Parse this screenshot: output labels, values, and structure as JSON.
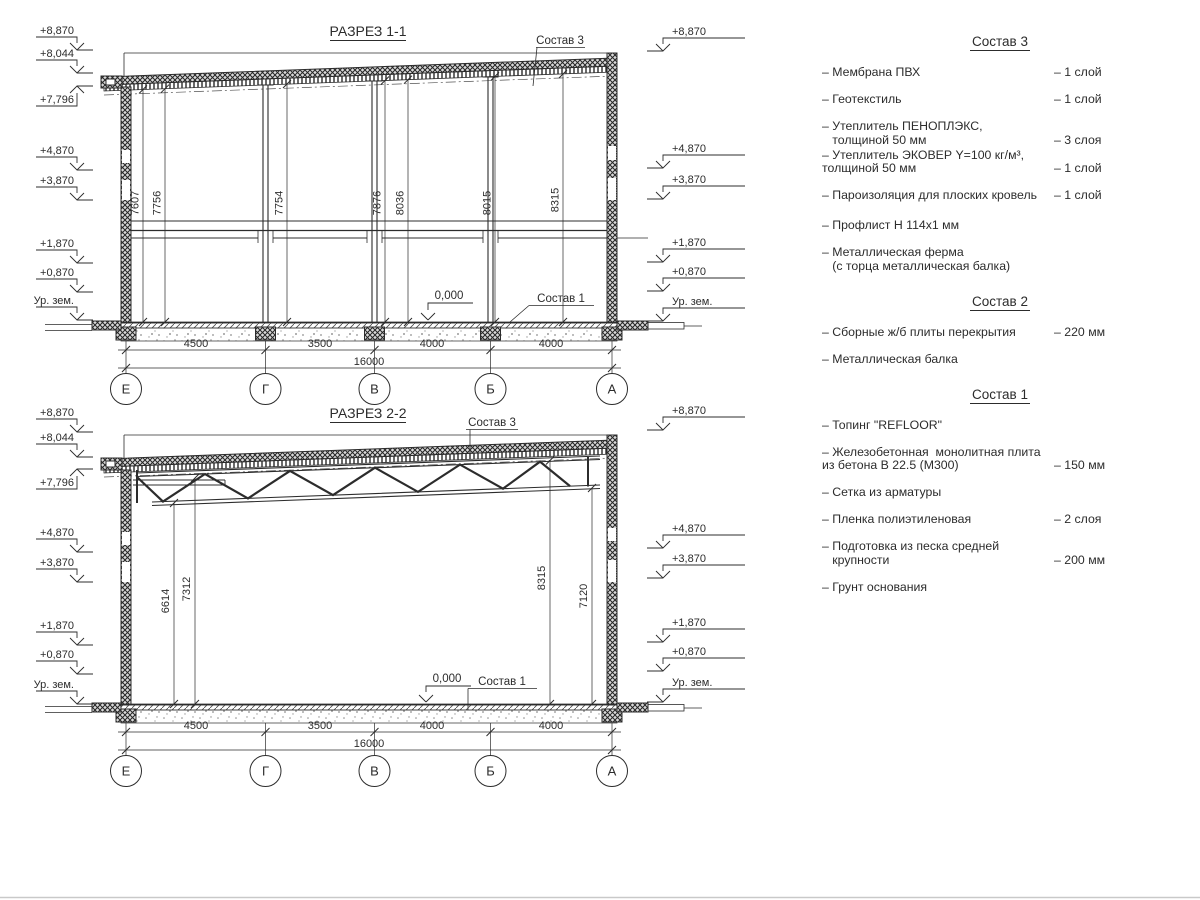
{
  "s1": {
    "title": "РАЗРЕЗ 1-1",
    "sostav3": "Состав 3",
    "sostav1": "Состав 1",
    "zero": "0,000",
    "vdims": [
      "7607",
      "7756",
      "7754",
      "7876",
      "8036",
      "8015",
      "8315"
    ],
    "spans": [
      "4500",
      "3500",
      "4000",
      "4000"
    ],
    "total": "16000",
    "axes": [
      "Е",
      "Г",
      "В",
      "Б",
      "А"
    ],
    "left_levels": [
      "+8,870",
      "+8,044",
      "+7,796",
      "+4,870",
      "+3,870",
      "+1,870",
      "+0,870",
      "Ур. зем."
    ],
    "right_levels": [
      "+8,870",
      "+4,870",
      "+3,870",
      "+1,870",
      "+0,870",
      "Ур. зем."
    ]
  },
  "s2": {
    "title": "РАЗРЕЗ 2-2",
    "sostav3": "Состав 3",
    "sostav1": "Состав 1",
    "zero": "0,000",
    "vdims": [
      "6614",
      "7312",
      "8315",
      "7120"
    ],
    "spans": [
      "4500",
      "3500",
      "4000",
      "4000"
    ],
    "total": "16000",
    "axes": [
      "Е",
      "Г",
      "В",
      "Б",
      "А"
    ],
    "left_levels": [
      "+8,870",
      "+8,044",
      "+7,796",
      "+4,870",
      "+3,870",
      "+1,870",
      "+0,870",
      "Ур. зем."
    ],
    "right_levels": [
      "+8,870",
      "+4,870",
      "+3,870",
      "+1,870",
      "+0,870",
      "Ур. зем."
    ]
  },
  "legend": {
    "s3": {
      "title": "Состав 3",
      "items": [
        {
          "name": "– Мембрана ПВХ",
          "qty": "– 1 слой"
        },
        {
          "name": "– Геотекстиль",
          "qty": "– 1 слой"
        },
        {
          "name": "– Утеплитель ПЕНОПЛЭКС,\n   толщиной 50 мм",
          "qty": "– 3 слоя"
        },
        {
          "name": "– Утеплитель ЭКОВЕР Y=100 кг/м³,\nтолщиной 50 мм",
          "qty": "– 1 слой"
        },
        {
          "name": "– Пароизоляция для плоских кровель",
          "qty": "– 1 слой"
        },
        {
          "name": "– Профлист Н 114х1 мм",
          "qty": ""
        },
        {
          "name": "– Металлическая ферма\n   (с торца металлическая балка)",
          "qty": ""
        }
      ]
    },
    "s2": {
      "title": "Состав 2",
      "items": [
        {
          "name": "– Сборные ж/б плиты перекрытия",
          "qty": "– 220 мм"
        },
        {
          "name": "– Металлическая балка",
          "qty": ""
        }
      ]
    },
    "s1": {
      "title": "Состав 1",
      "items": [
        {
          "name": "– Топинг \"REFLOOR\"",
          "qty": ""
        },
        {
          "name": "– Железобетонная  монолитная плита\nиз бетона В 22.5 (М300)",
          "qty": "– 150 мм"
        },
        {
          "name": "– Сетка из арматуры",
          "qty": ""
        },
        {
          "name": "– Пленка полиэтиленовая",
          "qty": "–  2 слоя"
        },
        {
          "name": "– Подготовка из песка средней\n   крупности",
          "qty": "– 200 мм"
        },
        {
          "name": "– Грунт основания",
          "qty": ""
        }
      ]
    }
  }
}
